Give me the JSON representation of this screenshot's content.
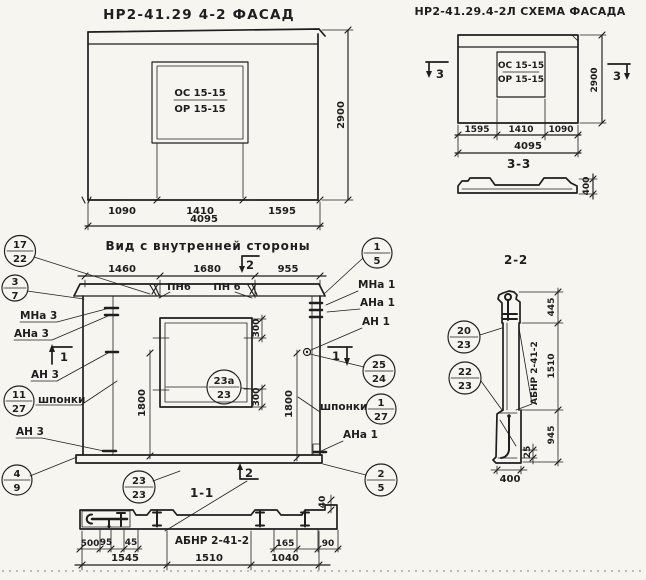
{
  "colors": {
    "paper": "#f6f5f0",
    "ink": "#1e1e1e"
  },
  "facade": {
    "title": "НР2-41.29 4-2 ФАСАД",
    "window_type_top": "ОС 15-15",
    "window_type_bottom": "ОР 15-15",
    "dim_height": "2900",
    "dim_left": "1090",
    "dim_mid": "1410",
    "dim_right": "1595",
    "dim_total": "4095"
  },
  "schema": {
    "title": "НР2-41.29.4-2Л СХЕМА ФАСАДА",
    "window_type_top": "ОС 15-15",
    "window_type_bottom": "ОР 15-15",
    "dim_height": "2900",
    "dim_left": "1595",
    "dim_mid": "1410",
    "dim_right": "1090",
    "dim_total": "4095",
    "marker_left": "3",
    "marker_right": "3"
  },
  "section33": {
    "title": "3-3",
    "dim_thickness": "400"
  },
  "inner_view": {
    "title": "Вид с внутренней стороны",
    "dim_top_left": "1460",
    "dim_top_mid": "1680",
    "dim_top_right": "955",
    "label_pn_left": "ПН6",
    "label_pn_right": "ПН 6",
    "label_mna3": "МНа 3",
    "label_ana3": "АНа 3",
    "label_an3_upper": "АН 3",
    "label_shponki_left": "шпонки",
    "label_an3_lower": "АН 3",
    "label_mna1": "МНа 1",
    "label_ana1": "АНа 1",
    "label_an1": "АН 1",
    "label_shponki_right": "шпонки",
    "label_ana1_lower": "АНа 1",
    "dim_side_left": "1800",
    "dim_side_right": "1800",
    "dim_win_top": "300",
    "dim_win_bottom": "300",
    "marker_top": "2",
    "marker_bottom": "2",
    "marker_left": "1",
    "marker_right": "1"
  },
  "section11": {
    "title": "1-1",
    "part_label": "АБНР 2-41-2",
    "dim_500": "500",
    "dim_95": "95",
    "dim_45": "45",
    "dim_165": "165",
    "dim_90": "90",
    "dim_40": "40",
    "dim_b1": "1545",
    "dim_b2": "1510",
    "dim_b3": "1040"
  },
  "section22": {
    "title": "2-2",
    "part_label": "АБНР 2-41-2",
    "dim_top": "445",
    "dim_mid": "1510",
    "dim_bottom": "945",
    "dim_lip": "25",
    "dim_width": "400"
  },
  "callouts": {
    "c17_22": {
      "num": "17",
      "den": "22"
    },
    "c3_7": {
      "num": "3",
      "den": "7"
    },
    "c11_27": {
      "num": "11",
      "den": "27"
    },
    "c4_9": {
      "num": "4",
      "den": "9"
    },
    "c1_5": {
      "num": "1",
      "den": "5"
    },
    "c25_24": {
      "num": "25",
      "den": "24"
    },
    "c1_27": {
      "num": "1",
      "den": "27"
    },
    "c2_5": {
      "num": "2",
      "den": "5"
    },
    "c23a_23": {
      "num": "23а",
      "den": "23"
    },
    "c23_23": {
      "num": "23",
      "den": "23"
    },
    "c20_23": {
      "num": "20",
      "den": "23"
    },
    "c22_23": {
      "num": "22",
      "den": "23"
    }
  }
}
